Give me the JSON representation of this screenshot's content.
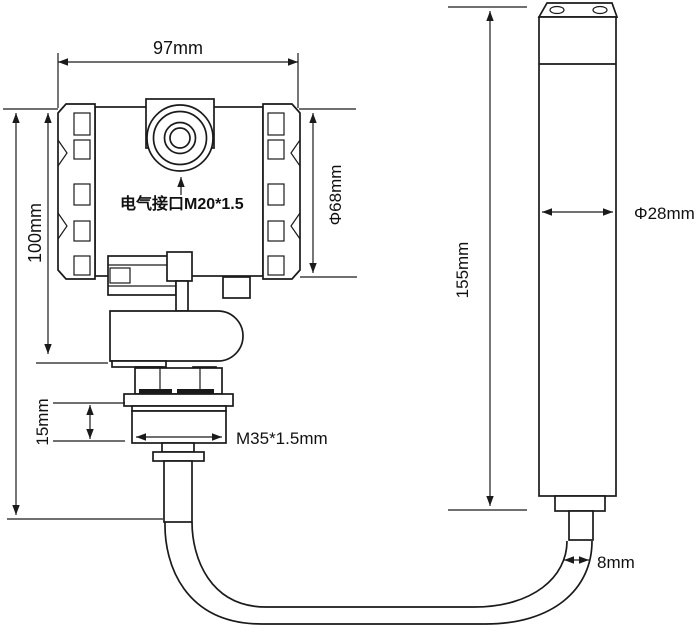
{
  "drawing": {
    "type": "technical-dimension-diagram",
    "subject": "submersible-level-transmitter-with-probe",
    "background_color": "#ffffff",
    "line_color": "#1a1a1a",
    "text_color": "#111111",
    "labels": {
      "head_width": "97mm",
      "head_height": "100mm",
      "head_diameter": "Φ68mm",
      "electrical_port": "电气接口M20*1.5",
      "thread_length": "15mm",
      "thread_spec": "M35*1.5mm",
      "probe_length": "155mm",
      "probe_diameter": "Φ28mm",
      "cable_diameter": "8mm"
    }
  }
}
